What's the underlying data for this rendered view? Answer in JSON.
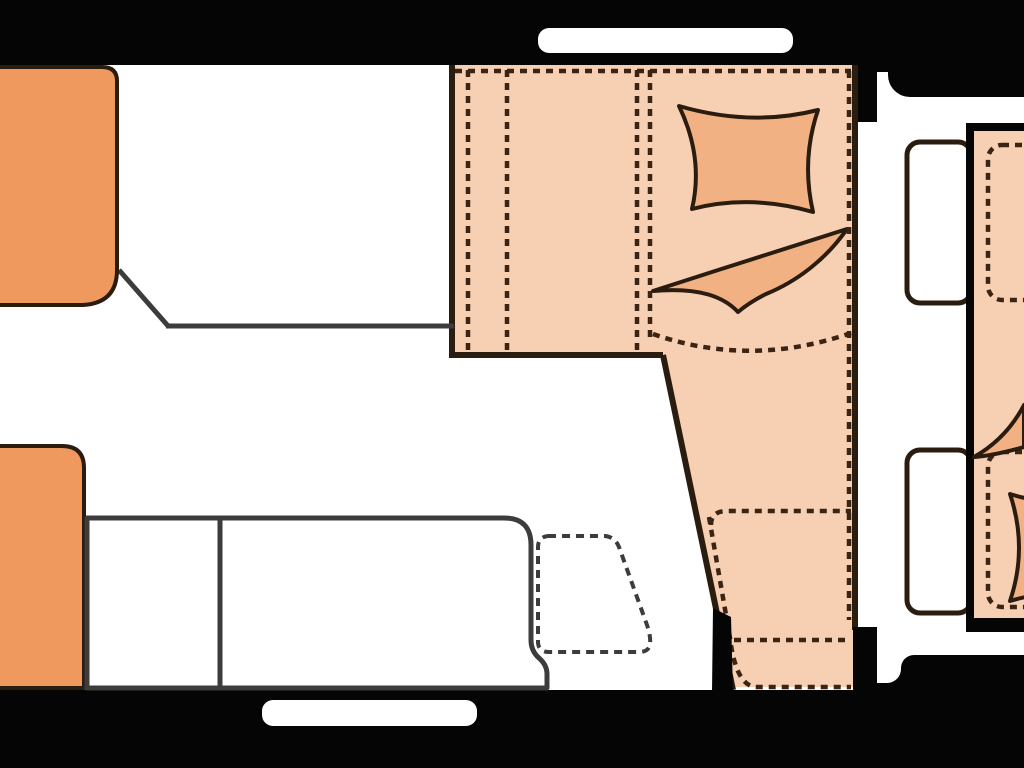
{
  "title": "caravan-floor-plan",
  "colors": {
    "bg": "#050505",
    "floor": "#ffffff",
    "peach": "#f7cfb2",
    "accent": "#f1b183",
    "orange": "#f0995f",
    "outline": "#2b1c10",
    "wall": "#3c3c3c",
    "dash": "#3b2414"
  },
  "legend": {
    "rooms": [
      {
        "name": "rear-bedroom",
        "floor_color": "#ffffff"
      },
      {
        "name": "living-kitchen-area",
        "floor_color": "#ffffff"
      },
      {
        "name": "fixed-bed-and-seating",
        "surface_color": "#f7cfb2"
      },
      {
        "name": "front-section-second-plan",
        "surface_color": "#f7cfb2"
      }
    ],
    "furniture": [
      {
        "name": "wardrobe-block-top-left",
        "color": "#f0995f"
      },
      {
        "name": "cabinet-block-bottom-left",
        "color": "#f0995f"
      },
      {
        "name": "kitchen-counter",
        "color": "#ffffff"
      },
      {
        "name": "shower-tray-dashed",
        "style": "dashed"
      },
      {
        "name": "bed-pillow",
        "color": "#f1b183"
      },
      {
        "name": "bed-blanket",
        "color": "#f1b183"
      },
      {
        "name": "seat-cushions-dashed",
        "style": "dashed"
      }
    ],
    "openings": [
      {
        "name": "window-top"
      },
      {
        "name": "window-bottom"
      },
      {
        "name": "window-right-upper"
      },
      {
        "name": "window-right-lower"
      },
      {
        "name": "entry-door-top-right"
      }
    ]
  }
}
